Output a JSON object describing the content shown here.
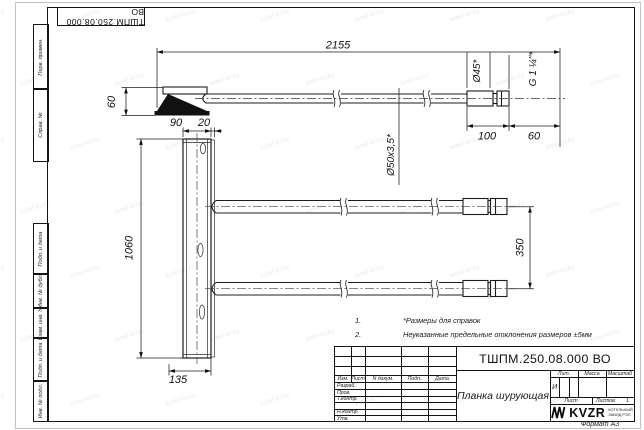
{
  "sheet": {
    "format_note": "Формат А3",
    "watermark_text": "kotel-kv.kz"
  },
  "top_stamp": {
    "doc_number": "ТШПМ.250.08.000 ВО"
  },
  "margin_columns": {
    "perv_primen": "Перв. примен.",
    "sprav_no": "Справ. №",
    "podp_i_data_upper": "Подп. и дата",
    "inv_no_dubl": "Инв. № дубл.",
    "vzam_inv_no": "Взам. инв. №",
    "podp_i_data_lower": "Подп. и дата",
    "inv_no_podl": "Инв. № подл."
  },
  "dimensions": {
    "overall_length": "2155",
    "blade_height": "60",
    "plate_width": "90",
    "flange_width": "20",
    "plate_length": "1060",
    "plate_base": "135",
    "pipe_end_spacing": "350",
    "tip_length": "100",
    "thread_length": "60",
    "tip_diameter": "Ø45*",
    "pipe_diameter": "Ø50x3,5*",
    "thread_size": "G 1 ¼\"*"
  },
  "notes": {
    "items": [
      {
        "num": "1.",
        "text": "*Размеры для справок"
      },
      {
        "num": "2.",
        "text": "Неуказанные предельные отклонения размеров ±5мм"
      }
    ]
  },
  "title_block": {
    "doc_number": "ТШПМ.250.08.000 ВО",
    "part_name": "Планка шурующая",
    "columns": {
      "izm": "Изм.",
      "list": "Лист",
      "n_dokum": "N докум.",
      "podp": "Подп.",
      "data": "Дата"
    },
    "rows": {
      "razrab": "Разраб.",
      "prov": "Пров.",
      "t_kontr": "Т.контр.",
      "n_kontr": "Н.контр.",
      "utv": "Утв."
    },
    "lit_label": "Лит.",
    "massa_label": "Масса",
    "masshtab_label": "Масштаб",
    "lit_value": "И",
    "list_label": "Лист",
    "listov_label": "Листов",
    "listov_value": "1",
    "logo_text": "KVZR",
    "company_line1": "КОТЕЛЬНЫЙ",
    "company_line2": "ЗАВОД РЭП"
  }
}
